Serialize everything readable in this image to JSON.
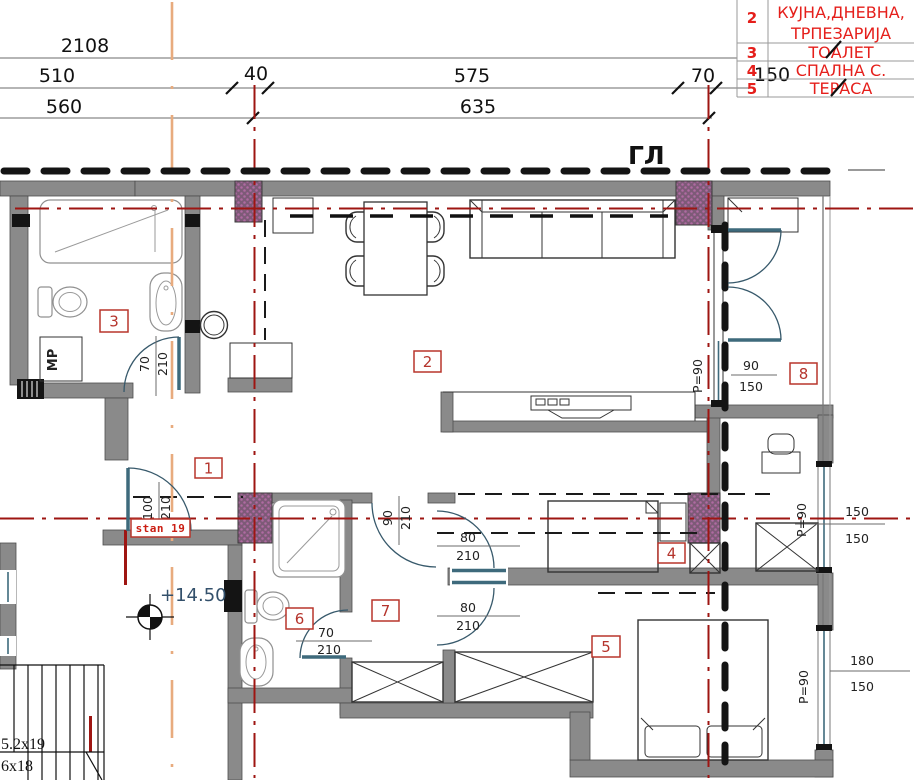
{
  "title": "Apartment floor plan — stan 19",
  "colors": {
    "wall_gray": "#8a8a8a",
    "column_purple": "#7d5a77",
    "column_dot": "#b06aa2",
    "centerline_red": "#9e1512",
    "construction_orange": "#e8ab7e",
    "glazing_teal": "#3e6a7c",
    "tag_red": "#b5342c",
    "legend_red": "#e51f1b",
    "level_blue": "#33506b"
  },
  "dims": {
    "total": "2108",
    "r2": [
      "510",
      "40",
      "575",
      "70"
    ],
    "r3": [
      "560",
      "635"
    ],
    "overlap": "150"
  },
  "legend": {
    "rows": [
      {
        "num": "2",
        "l1": "КУЈНА,ДНЕВНА,",
        "l2": "ТРПЕЗАРИЈА"
      },
      {
        "num": "3",
        "l1": "ТОАЛЕТ",
        "l2": ""
      },
      {
        "num": "4",
        "l1": "СПАЛНА С.",
        "l2": ""
      },
      {
        "num": "5",
        "l1": "ТЕРАСА",
        "l2": ""
      }
    ]
  },
  "tags": {
    "t1": "1",
    "t2": "2",
    "t3": "3",
    "t4": "4",
    "t5": "5",
    "t6": "6",
    "t7": "7",
    "t8": "8"
  },
  "openings": {
    "bath": {
      "w": "70",
      "h": "210"
    },
    "entry": {
      "w": "100",
      "h": "210"
    },
    "hall_upper": {
      "w": "90",
      "h": "210"
    },
    "bed_door": {
      "w": "80",
      "h": "210"
    },
    "hall_lower": {
      "w": "80",
      "h": "210"
    },
    "toilet": {
      "w": "70",
      "h": "210"
    }
  },
  "windows": {
    "terrace": {
      "w": "90",
      "h": "150",
      "p": "P=90"
    },
    "study": {
      "w": "150",
      "h": "150",
      "p": "P=90"
    },
    "bedroom": {
      "w": "180",
      "h": "150",
      "p": "P=90"
    }
  },
  "notes": {
    "section": "ГЛ",
    "apartment": "stan 19",
    "level": "+14.50",
    "washer": "МР",
    "stair1": "5.2x19",
    "stair2": "6x18"
  }
}
